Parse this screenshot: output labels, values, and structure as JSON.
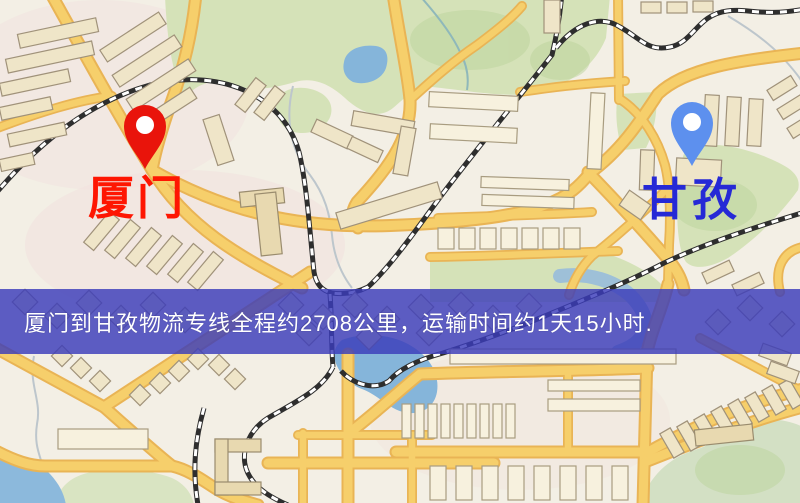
{
  "banner": {
    "text": "厦门到甘孜物流专线全程约2708公里，运输时间约1天15小时.",
    "background_color": "#3a3cba",
    "text_color": "#ffffff"
  },
  "route": {
    "origin": "厦门",
    "destination": "甘孜",
    "distance_km": 2708,
    "duration": "1天15小时"
  },
  "markers": {
    "origin": {
      "label": "厦门",
      "pin_color": "#e9140b",
      "label_color": "#fe1602"
    },
    "destination": {
      "label": "甘孜",
      "pin_color": "#5d90ee",
      "label_color": "#2629d6"
    }
  },
  "map_palette": {
    "background": "#f3efe5",
    "road_fill": "#f6cf6b",
    "road_casing": "#e9b455",
    "park_green": "#d5e2b8",
    "water_blue": "#85b5da",
    "building_fill": "#efe5c8",
    "building_stroke": "#a0927a",
    "railway_color": "#2e2e2e"
  }
}
